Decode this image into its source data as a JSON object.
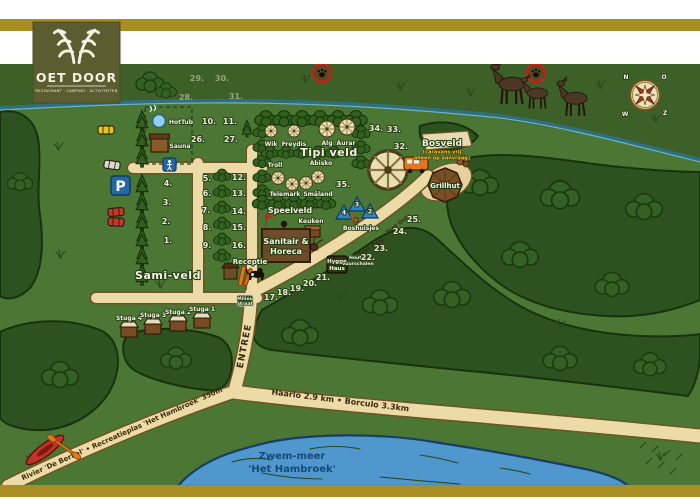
{
  "logo": {
    "title": "OET DOOR",
    "subtitle": "RESTAURANT · CAMPING · ACTIVITEITEN"
  },
  "areas": {
    "sami_veld": "Sami-veld",
    "tipi_veld": "Tipi veld",
    "bosveld": "Bosveld",
    "bosveld_note_1": "(caravans vrij",
    "bosveld_note_2": "alleen op aanvraag)",
    "speelveld": "Speelveld",
    "boshuisjes": "Boshuisjes"
  },
  "places": {
    "hottub": "HotTub",
    "sauna": "Sauna",
    "sanitair_line1": "Sanitair &",
    "sanitair_line2": "Horeca",
    "keuken": "Keuken",
    "receptie": "Receptie",
    "grillhut": "Grillhut",
    "hygge_line1": "Hygge",
    "hygge_line2": "Haus",
    "hygge_note_1": "Hout +",
    "hygge_note_2": "vuurschalen",
    "milieu_line1": "Milieu",
    "milieu_line2": "straat",
    "parking": "P"
  },
  "stugas": [
    {
      "label": "Stuga 4"
    },
    {
      "label": "Stuga 3"
    },
    {
      "label": "Stuga 2"
    },
    {
      "label": "Stuga 1"
    }
  ],
  "tipis": [
    {
      "name": "Wik"
    },
    {
      "name": "Freydis"
    },
    {
      "name": "Alg"
    },
    {
      "name": "Aurar"
    },
    {
      "name": "Troll"
    },
    {
      "name": "Abisko"
    },
    {
      "name": "Telemark"
    },
    {
      "name": "Småland"
    }
  ],
  "bos_tents": [
    {
      "n": "4"
    },
    {
      "n": "3"
    },
    {
      "n": "2"
    }
  ],
  "pitches": [
    {
      "n": "1."
    },
    {
      "n": "2."
    },
    {
      "n": "3."
    },
    {
      "n": "4."
    },
    {
      "n": "5."
    },
    {
      "n": "6."
    },
    {
      "n": "7."
    },
    {
      "n": "8."
    },
    {
      "n": "9."
    },
    {
      "n": "10."
    },
    {
      "n": "11."
    },
    {
      "n": "12."
    },
    {
      "n": "13."
    },
    {
      "n": "14."
    },
    {
      "n": "15."
    },
    {
      "n": "16."
    },
    {
      "n": "17."
    },
    {
      "n": "18."
    },
    {
      "n": "19."
    },
    {
      "n": "20."
    },
    {
      "n": "21."
    },
    {
      "n": "22."
    },
    {
      "n": "23."
    },
    {
      "n": "24."
    },
    {
      "n": "25."
    },
    {
      "n": "26."
    },
    {
      "n": "27."
    },
    {
      "n": "28."
    },
    {
      "n": "29."
    },
    {
      "n": "30."
    },
    {
      "n": "31."
    },
    {
      "n": "32."
    },
    {
      "n": "33."
    },
    {
      "n": "34."
    },
    {
      "n": "35."
    }
  ],
  "roads": {
    "entree": "ENTREE",
    "haarlo_borculo": "Haarlo 2.9 km • Borculo 3.3km",
    "rivier": "Rivier 'De Berkel' • Recreatieplas 'Het Hambroek' 350m",
    "tent_only": "Tent Only"
  },
  "water": {
    "lake_line1": "Zwem-meer",
    "lake_line2": "'Het Hambroek'"
  },
  "compass": {
    "n": "N",
    "e": "O",
    "s": "Z",
    "w": "W"
  },
  "colors": {
    "band_gold": "#a98e24",
    "logo_olive": "#5b5c2f",
    "field_green": "#4c7633",
    "forest_green": "#2d5220",
    "road_cream": "#ecdaa7",
    "water_blue": "#4f97cc",
    "accent_red": "#c0241d",
    "accent_orange": "#e2761b",
    "sign_brown": "#6f4c28",
    "tent_blue": "#2f86c4",
    "text_cream": "#f7f2df",
    "note_yellow": "#f2cf2a"
  }
}
